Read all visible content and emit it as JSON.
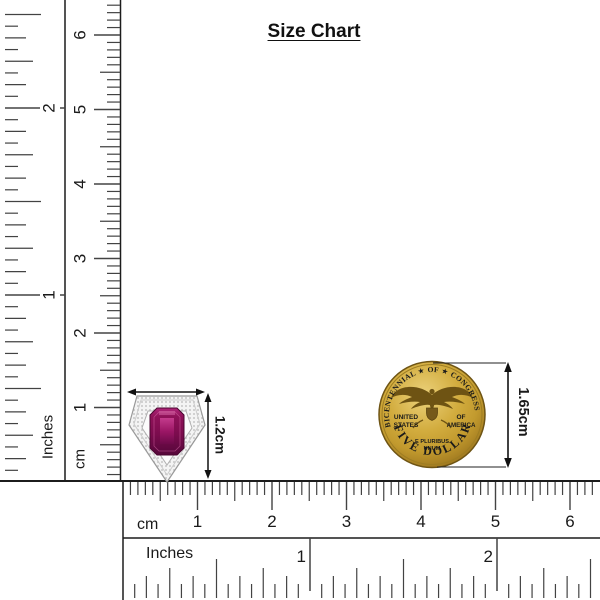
{
  "title": "Size Chart",
  "rulers": {
    "px_per_cm": 74.5,
    "px_per_inch": 187,
    "left_inches": {
      "label": "Inches",
      "numbers": [
        "1",
        "2"
      ]
    },
    "left_cm": {
      "label": "cm",
      "numbers": [
        "1",
        "2",
        "3",
        "4",
        "5",
        "6"
      ]
    },
    "bottom_cm": {
      "label": "cm",
      "numbers": [
        "1",
        "2",
        "3",
        "4",
        "5",
        "6"
      ]
    },
    "bottom_inches": {
      "label": "Inches",
      "numbers": [
        "1",
        "2"
      ]
    }
  },
  "pendant": {
    "height_label": "1.2cm",
    "stone_color_dark": "#55073a",
    "stone_color_mid": "#8c1158",
    "stone_color_light": "#b5307f",
    "metal_color": "#f3f3f3"
  },
  "coin": {
    "top_text": "BICENTENNIAL ★ OF ★ CONGRESS",
    "bottom_text": "FIVE DOLLARS",
    "left_line1": "UNITED",
    "left_line2": "STATES",
    "right_line1": "OF",
    "right_line2": "AMERICA",
    "motto_line1": "E PLURIBUS",
    "motto_line2": "UNUM",
    "height_label": "1.65cm",
    "gold_color": "#c59f33"
  }
}
